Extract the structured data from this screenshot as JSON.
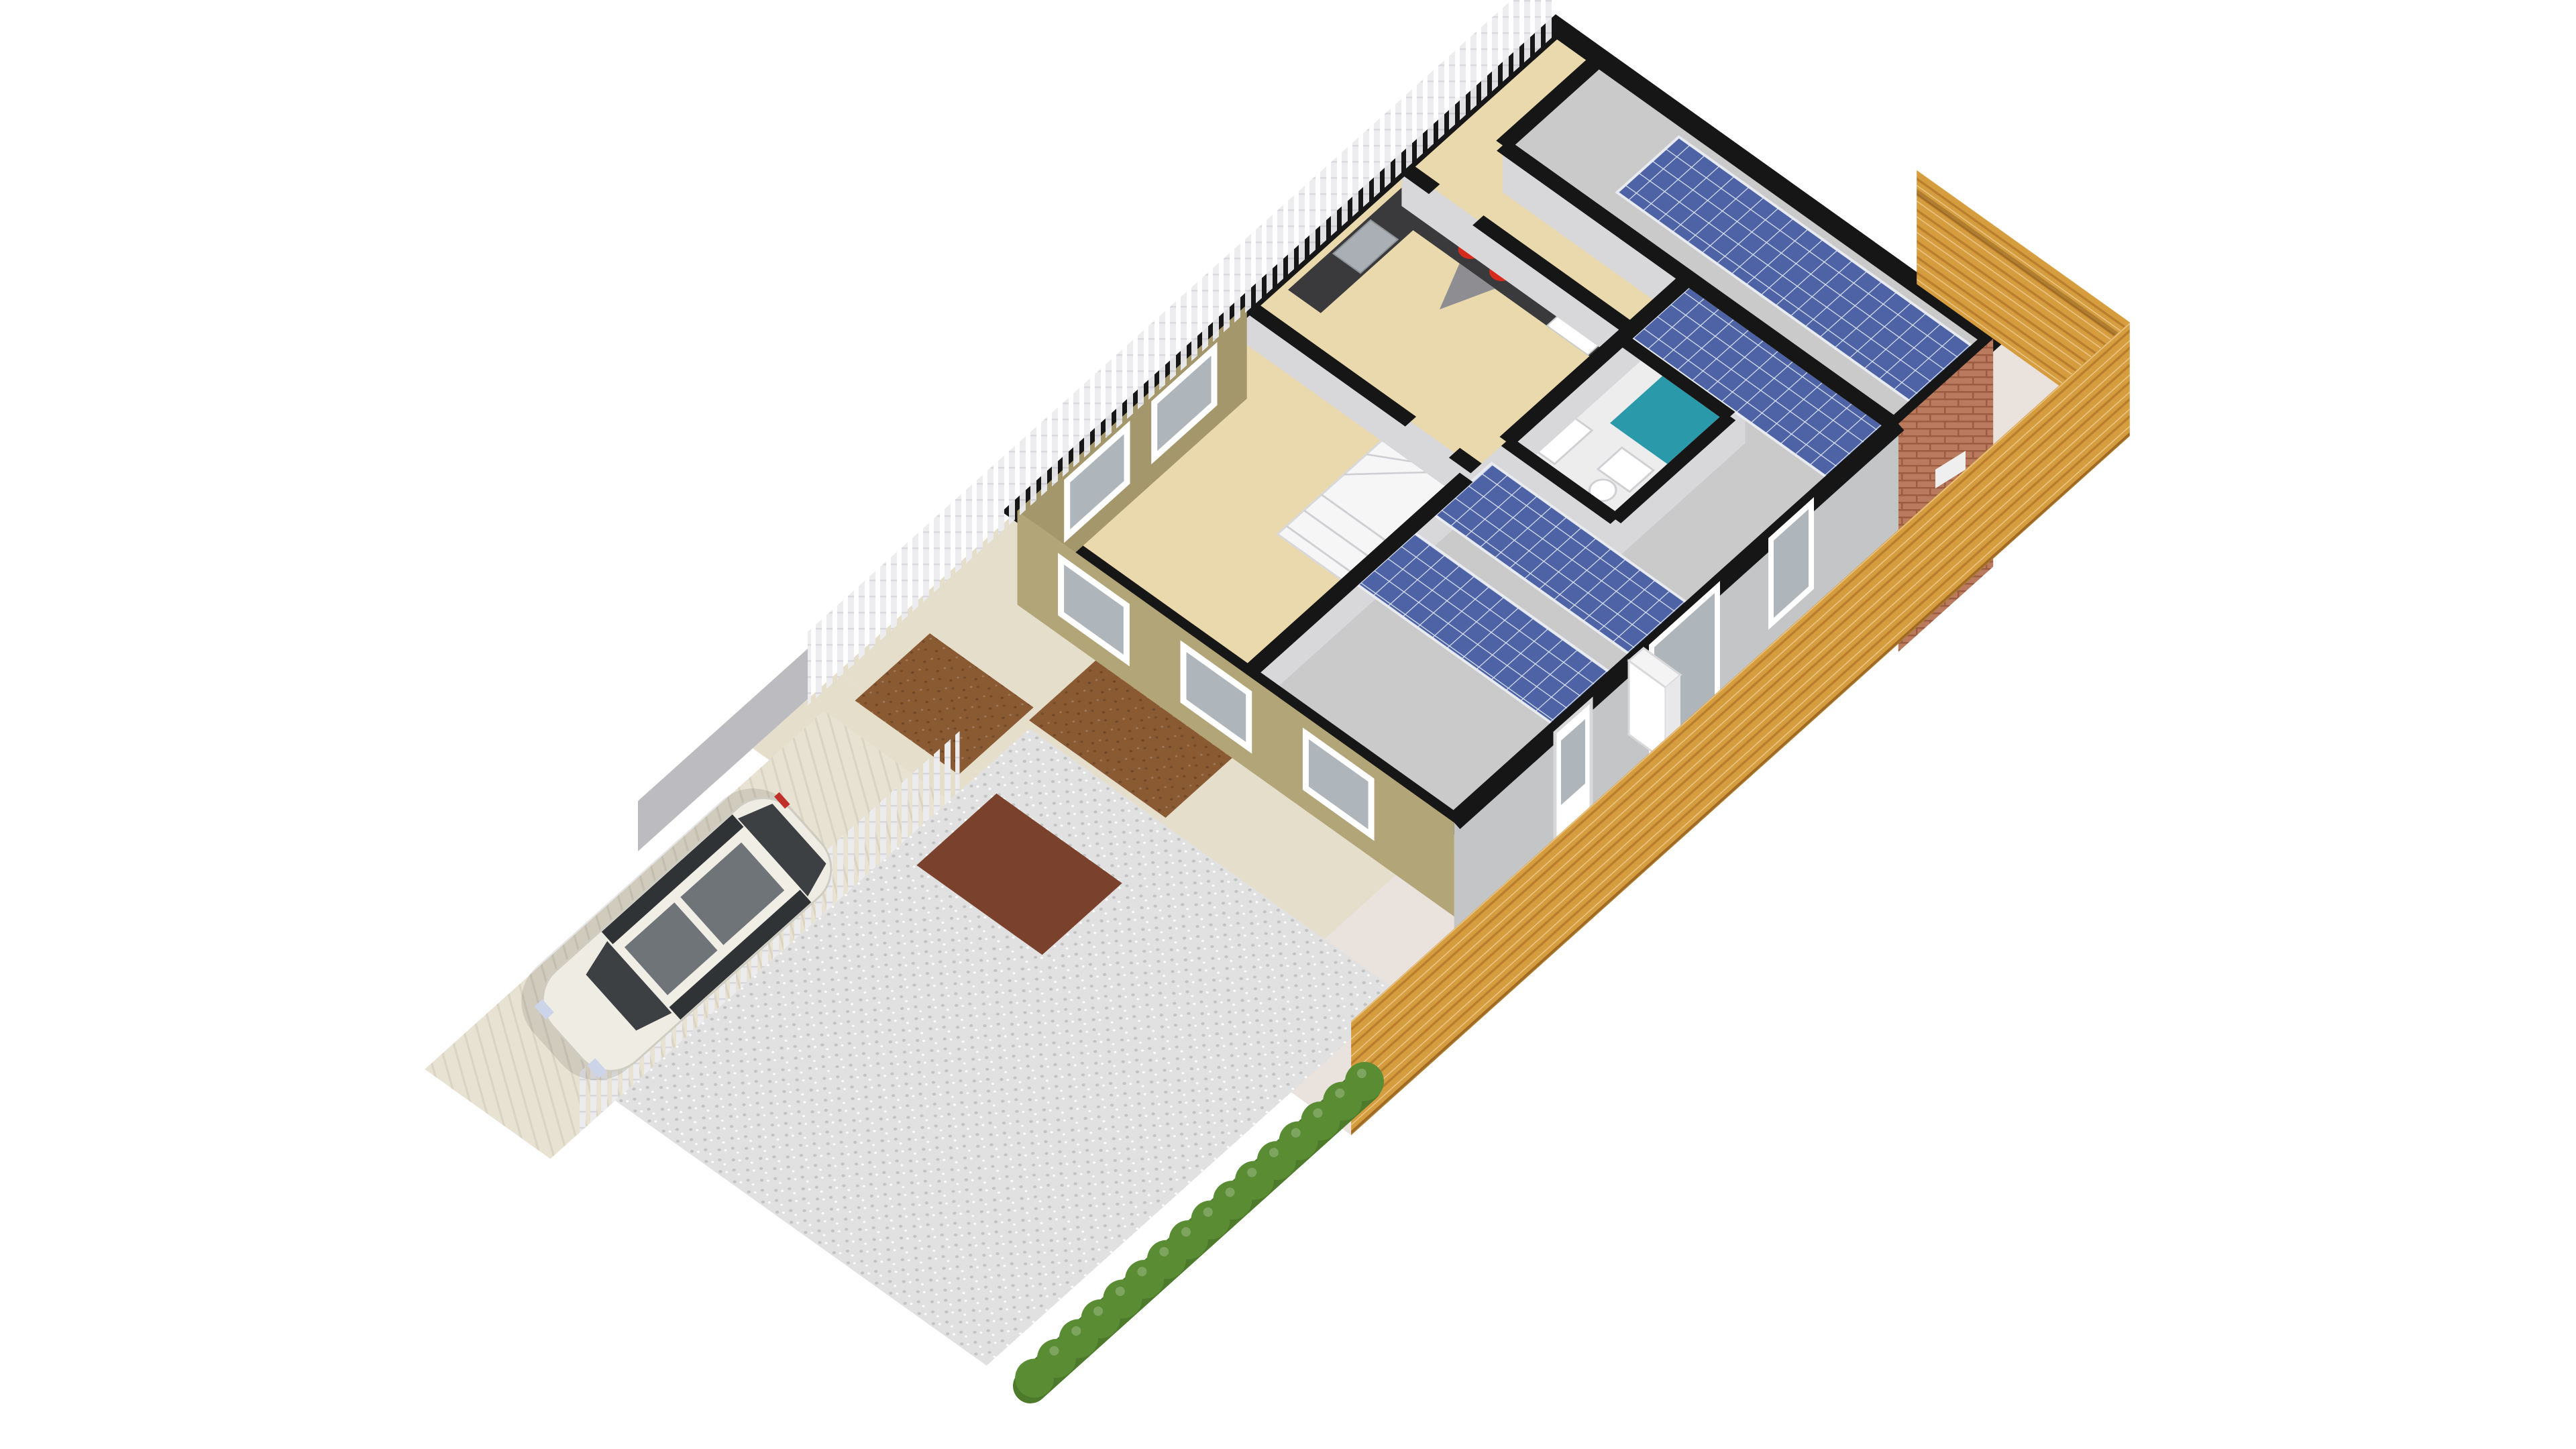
{
  "scene": {
    "type": "3d-floorplan-render",
    "view": "isometric-cutaway-dollhouse",
    "background": "#ffffff",
    "visible_text": ""
  },
  "house": {
    "solar_panel_arrays": 4,
    "storeys_visible": "ground-floor cutaway with roof deck above right wing",
    "rooms_visible": [
      "living-room",
      "kitchen",
      "rear-bedroom",
      "bathroom",
      "hallway"
    ],
    "fixtures": [
      "winder-staircase",
      "kitchen-counter",
      "hob-two-red-burners",
      "range-hood",
      "kitchen-sink",
      "bathroom-shower-teal",
      "bathroom-sink",
      "toilet",
      "white-appliance-on-patio"
    ],
    "exterior_finishes": [
      "khaki-stucco-front-walls",
      "brick-rear-wall",
      "gray-side-wall",
      "white-framed-windows",
      "white-back-door",
      "sliding-glass-doors"
    ]
  },
  "exterior": {
    "vehicle": "white minivan parked on driveway facing street",
    "fences": [
      "wooden-slat-fence-right-boundary",
      "wooden-slat-fence-rear-boundary",
      "white-picket-fence-left-boundary",
      "white-picket-fence-along-driveway",
      "gray-wall-panel"
    ],
    "landscape": [
      "gravel-yard",
      "green-hedge-row",
      "cream-front-path",
      "brown-flower-beds",
      "glossy-terrace-path",
      "cream-driveway"
    ]
  },
  "colors": {
    "wall": "#161616",
    "floor": "#ead9ac",
    "roof": "#cacaca",
    "wallface": "#d8d8db",
    "solar": "#4d63a6",
    "solargrid": "#dfe6f2",
    "teal": "#2a9aaa",
    "bathfloor": "#ededee",
    "stucco": "#b2a578",
    "stuccodark": "#a4976c",
    "sidewall": "#c3c5c7",
    "glass": "#aeb6bc",
    "terrace": "#eae2dd",
    "path": "#e5decb",
    "brown": "#8a5a33",
    "browndark": "#7a412c",
    "gravel": "#e1e1e1",
    "graveldot": "#c3c3c3",
    "drive": "#e8e2d3",
    "wood": "#d69d3f",
    "wooddark": "#b97f2e",
    "picket": "#ececef",
    "graywall": "#bcbcc0",
    "hedge": "#5a8c34",
    "hedgedark": "#4d7a2b",
    "brick": "#b97a5e",
    "brickline": "#9c5c41",
    "counter": "#3a3a3c",
    "burner": "#d62a1d",
    "white": "#ffffff",
    "carbody": "#efece4",
    "carglass": "#3c4043",
    "bg": "#ffffff"
  }
}
